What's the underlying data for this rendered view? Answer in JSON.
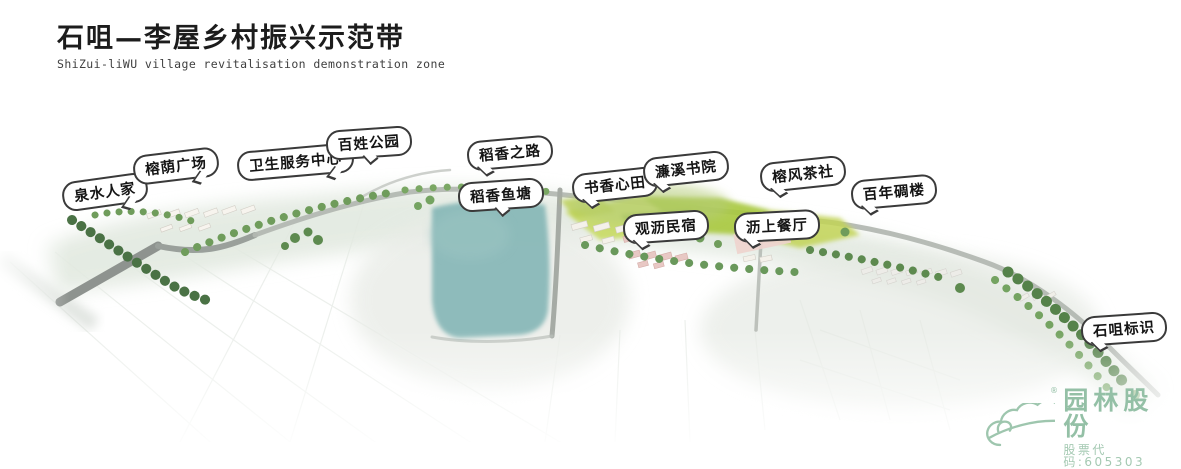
{
  "header": {
    "title_cn": "石咀—李屋乡村振兴示范带",
    "title_en": "ShiZui-liWU village revitalisation demonstration zone"
  },
  "map": {
    "labels": [
      {
        "id": "quanshui-renjia",
        "text": "泉水人家",
        "x": 62,
        "y": 177,
        "rot": -8,
        "tail": "br"
      },
      {
        "id": "rongyin-guangchang",
        "text": "榕荫广场",
        "x": 133,
        "y": 151,
        "rot": -7,
        "tail": "br"
      },
      {
        "id": "weisheng-zhongxin",
        "text": "卫生服务中心",
        "x": 237,
        "y": 147,
        "rot": -5,
        "tail": "br"
      },
      {
        "id": "baixing-gongyuan",
        "text": "百姓公园",
        "x": 326,
        "y": 128,
        "rot": -4,
        "tail": "bc"
      },
      {
        "id": "daoxiang-zhilu",
        "text": "稻香之路",
        "x": 467,
        "y": 138,
        "rot": -5,
        "tail": "bl"
      },
      {
        "id": "daoxiang-yutang",
        "text": "稻香鱼塘",
        "x": 458,
        "y": 180,
        "rot": -4,
        "tail": "bc"
      },
      {
        "id": "shuxiang-xintian",
        "text": "书香心田",
        "x": 572,
        "y": 170,
        "rot": -6,
        "tail": "bl"
      },
      {
        "id": "lianxi-shuyuan",
        "text": "濂溪书院",
        "x": 643,
        "y": 154,
        "rot": -6,
        "tail": "bl"
      },
      {
        "id": "guanli-minsu",
        "text": "观沥民宿",
        "x": 623,
        "y": 212,
        "rot": -4,
        "tail": "bl"
      },
      {
        "id": "lishang-canting",
        "text": "沥上餐厅",
        "x": 734,
        "y": 211,
        "rot": -3,
        "tail": "bl"
      },
      {
        "id": "rongfeng-chashe",
        "text": "榕风茶社",
        "x": 760,
        "y": 159,
        "rot": -6,
        "tail": "bl"
      },
      {
        "id": "bainian-diaolou",
        "text": "百年碉楼",
        "x": 851,
        "y": 177,
        "rot": -5,
        "tail": "bl"
      },
      {
        "id": "shizui-biaoshi",
        "text": "石咀标识",
        "x": 1081,
        "y": 314,
        "rot": -4,
        "tail": "bl"
      }
    ]
  },
  "logo": {
    "company": "园林股份",
    "stock_code": "股票代码:605303",
    "registered_mark": "®"
  },
  "icons": {
    "logo_mark": "cloud-hill-logo-icon"
  },
  "colors": {
    "title_text": "#1c1c1c",
    "subtitle_text": "#3f3f3f",
    "callout_border": "#3a3a3a",
    "callout_bg": "#ffffff",
    "logo_green": "#94c0a6",
    "logo_green_light": "#a4c9b2",
    "pond_teal": "#84b6b6",
    "field_green": "#b8d24e",
    "tree_green": "#5d8a4f",
    "road_gray": "#b3b8b2"
  }
}
